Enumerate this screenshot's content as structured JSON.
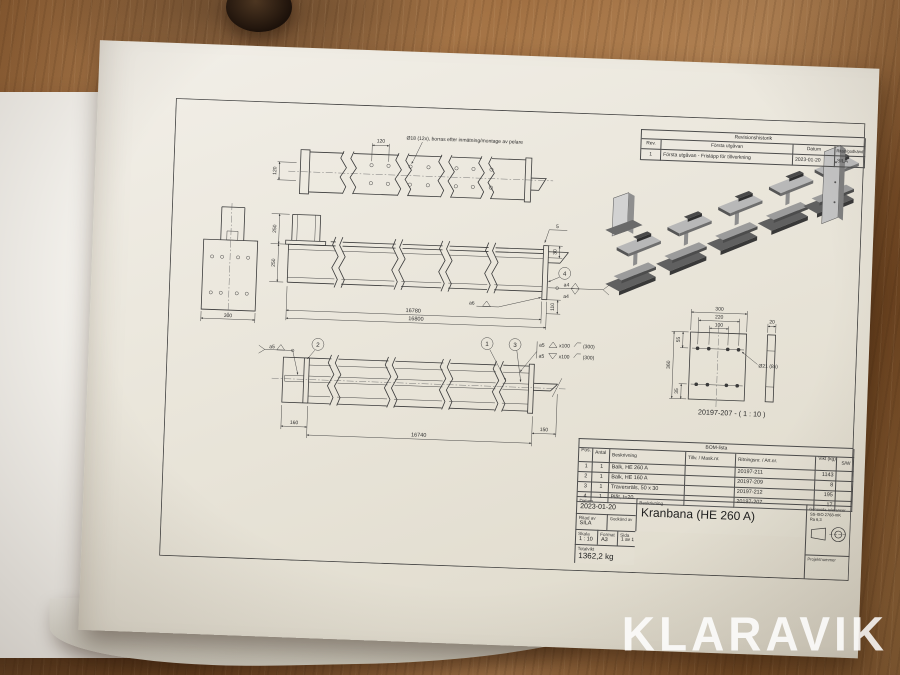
{
  "watermark": "KLARAVIK",
  "revision_table": {
    "title": "Revisionshistorik",
    "col_rev": "Rev.",
    "col_desc": "Första utgåvan",
    "col_datum": "Datum",
    "col_sign": "Ritad/godkänd",
    "row": {
      "rev": "1",
      "desc": "Första utgåvan - Frisläpp för tillverkning",
      "datum": "2023-01-20",
      "sign": "SILA"
    }
  },
  "drawing": {
    "top_view": {
      "note": "Ø18 (12x), borras efter inmätning/montage av pelare",
      "dim_spacing": "120",
      "dim_rows": "120"
    },
    "front_view": {
      "dim_col": "250",
      "dim_beam": "250",
      "dim_end": "300",
      "note_flag": "5",
      "dim_plate": "30",
      "balloon": "4",
      "weld_a4_top": "a4",
      "weld_a4_bot": "a4",
      "dim_bracket": "110",
      "weld_a6": "a6",
      "len_inner": "16780",
      "len_outer": "16800"
    },
    "bottom_view": {
      "weld_a5": "a5",
      "balloon_left": "2",
      "balloon_r1": "1",
      "balloon_r2": "3",
      "note1_a": "a5",
      "note1_pitch": "x100",
      "note1_len": "(300)",
      "note2_a": "a5",
      "note2_pitch": "x100",
      "note2_len": "(300)",
      "dim_left": "160",
      "dim_len": "16740",
      "dim_right": "150"
    },
    "detail_view": {
      "dim_width": "300",
      "dim_group": "220",
      "dim_inner": "100",
      "dim_thk": "20",
      "hole_note": "Ø21 (8x)",
      "dim_height": "360",
      "dim_top": "55",
      "dim_bot": "35",
      "caption": "20197-207 - ( 1 : 10 )"
    }
  },
  "bom": {
    "title": "BOM-lista",
    "cols": {
      "pos": "Pos.",
      "antal": "Antal",
      "beskrivning": "Beskrivning",
      "tillv": "Tillv. / Mask.nr.",
      "ritningsnr": "Ritningsnr. / Art.nr.",
      "vikt": "Vikt (kg)",
      "sw": "S/W"
    },
    "rows": [
      {
        "pos": "1",
        "antal": "1",
        "beskrivning": "Balk, HE 260 A",
        "tillv": "",
        "ritningsnr": "20197-211",
        "vikt": "1143",
        "sw": ""
      },
      {
        "pos": "2",
        "antal": "1",
        "beskrivning": "Balk, HE 160 A",
        "tillv": "",
        "ritningsnr": "20197-209",
        "vikt": "8",
        "sw": ""
      },
      {
        "pos": "3",
        "antal": "1",
        "beskrivning": "Traversräls, 50 x 30",
        "tillv": "",
        "ritningsnr": "20197-212",
        "vikt": "195",
        "sw": ""
      },
      {
        "pos": "4",
        "antal": "1",
        "beskrivning": "Plåt, t=20",
        "tillv": "",
        "ritningsnr": "20197-207",
        "vikt": "17",
        "sw": ""
      }
    ]
  },
  "title_block": {
    "datum_label": "Datum",
    "datum": "2023-01-20",
    "beskrivning_label": "Beskrivning",
    "beskrivning": "Kranbana (HE 260 A)",
    "ritad_label": "Ritad av",
    "ritad": "SILA",
    "godkand_label": "Godkänd av",
    "godkand": "",
    "skala_label": "Skala",
    "skala": "1 : 10",
    "format_label": "Format",
    "format": "A3",
    "sida_label": "Sida",
    "sida": "1 av 1",
    "totalvikt_label": "Totalvikt",
    "totalvikt": "1362,2 kg",
    "tol_label": "Generella toleranser",
    "tol_line1": "SS-ISO 2768-mK",
    "tol_line2": "Ra 6,3",
    "projekt_label": "Projektnummer"
  }
}
